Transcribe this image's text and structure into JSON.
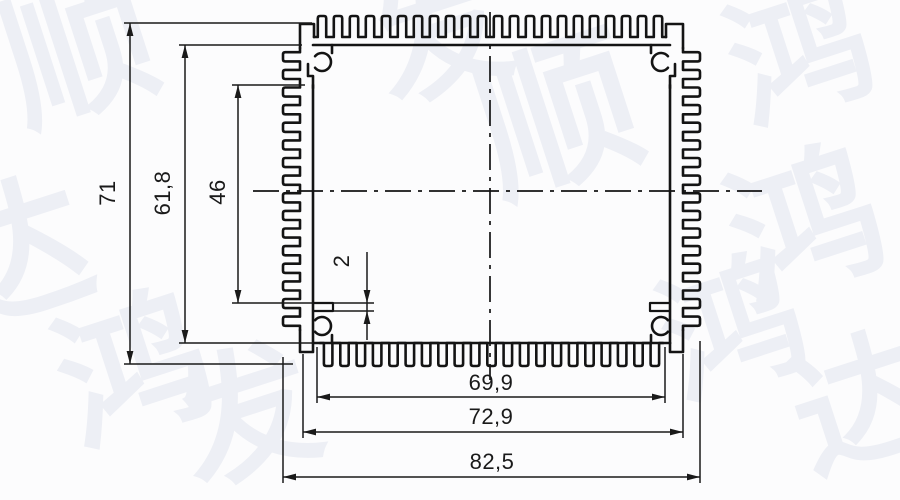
{
  "page": {
    "background": "#fcfcfd"
  },
  "drawing": {
    "line_color": "#141414",
    "dimension_color": "#1a1a1a",
    "dimensions": [
      {
        "id": "overall-height",
        "label": "71",
        "orientation": "vertical"
      },
      {
        "id": "inner-height",
        "label": "61,8",
        "orientation": "vertical"
      },
      {
        "id": "boss-clear-height",
        "label": "46",
        "orientation": "vertical"
      },
      {
        "id": "ledge-thickness",
        "label": "2",
        "orientation": "vertical"
      },
      {
        "id": "bottom-fin-span",
        "label": "69,9",
        "orientation": "horizontal"
      },
      {
        "id": "body-width",
        "label": "72,9",
        "orientation": "horizontal"
      },
      {
        "id": "overall-width",
        "label": "82,5",
        "orientation": "horizontal"
      }
    ],
    "watermark": {
      "color": "#edeff5",
      "rotation_deg": -18,
      "instances": [
        {
          "char": "顺",
          "x": 95,
          "y": 100,
          "size": 150
        },
        {
          "char": "达",
          "x": 30,
          "y": 305,
          "size": 150
        },
        {
          "char": "发",
          "x": 455,
          "y": 80,
          "size": 135
        },
        {
          "char": "顺",
          "x": 575,
          "y": 170,
          "size": 160
        },
        {
          "char": "鸿",
          "x": 815,
          "y": 100,
          "size": 140
        },
        {
          "char": "鸿",
          "x": 822,
          "y": 275,
          "size": 150
        },
        {
          "char": "鸿",
          "x": 748,
          "y": 375,
          "size": 140
        },
        {
          "char": "鸿",
          "x": 150,
          "y": 420,
          "size": 150
        },
        {
          "char": "发",
          "x": 262,
          "y": 462,
          "size": 140
        },
        {
          "char": "达",
          "x": 878,
          "y": 450,
          "size": 140
        }
      ]
    }
  }
}
